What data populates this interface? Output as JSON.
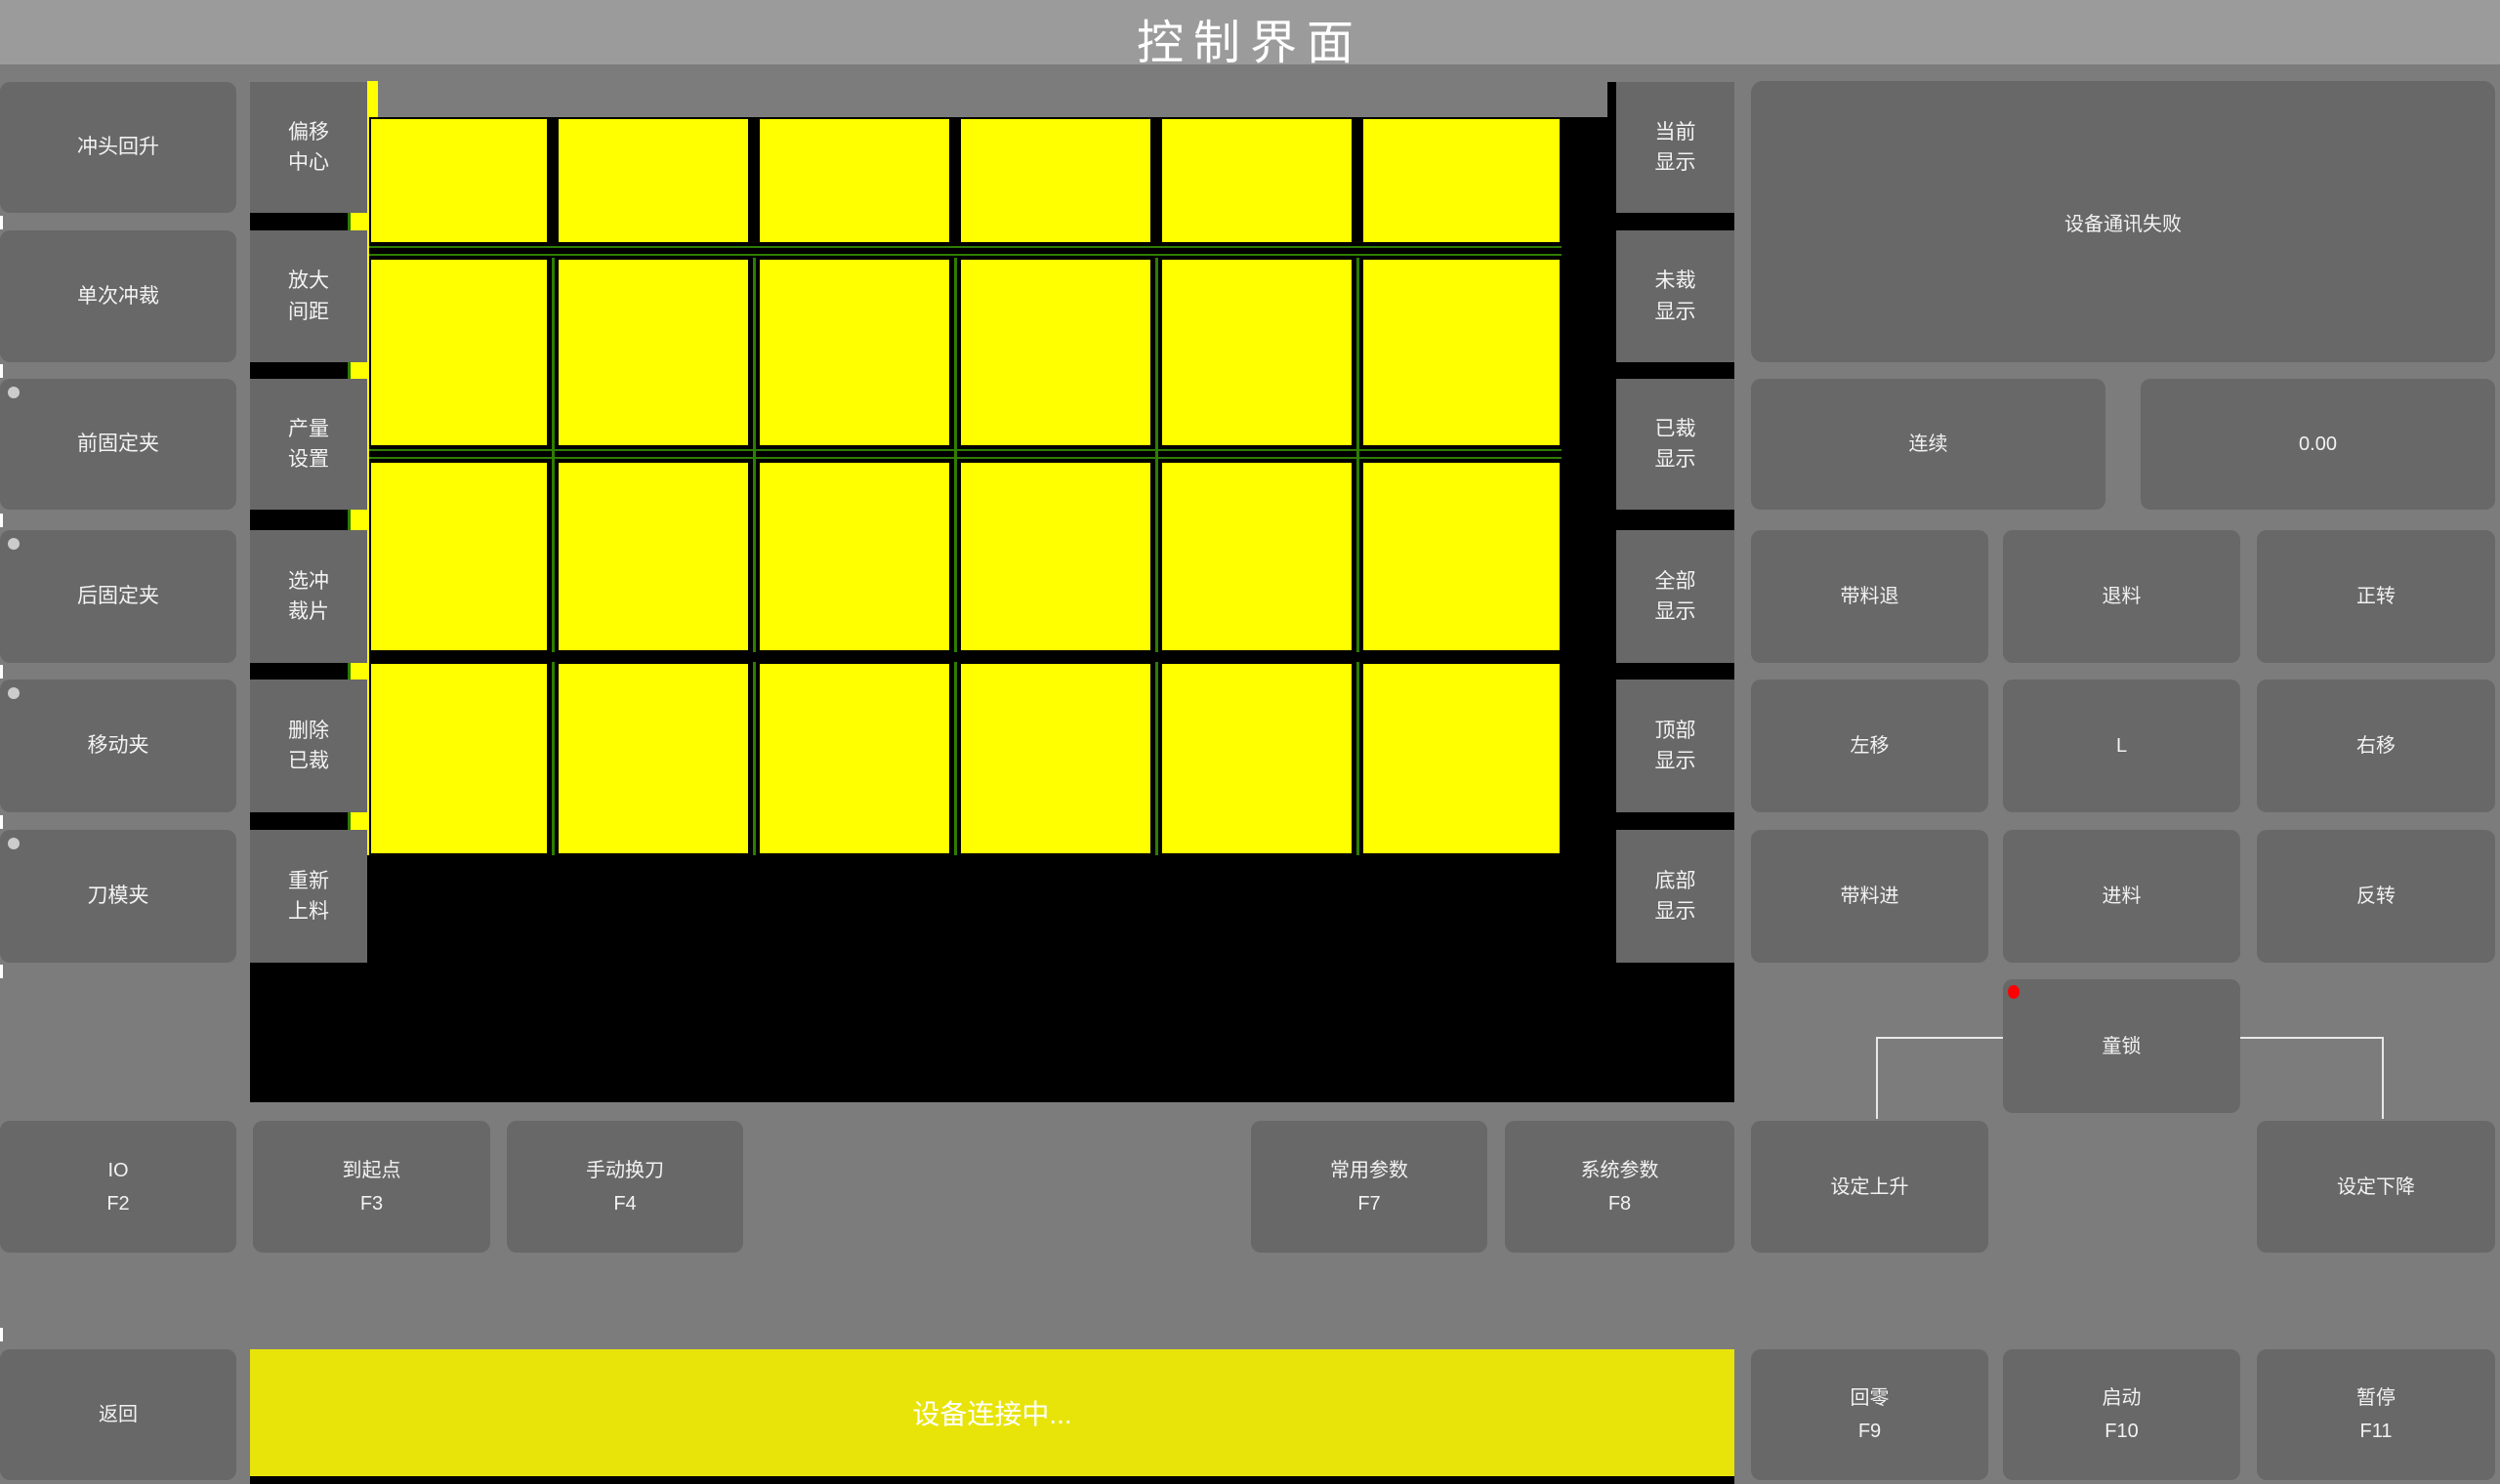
{
  "title": "控制界面",
  "left_panel": {
    "buttons": [
      {
        "label": "冲头回升",
        "indicator": false
      },
      {
        "label": "单次冲裁",
        "indicator": false
      },
      {
        "label": "前固定夹",
        "indicator": true
      },
      {
        "label": "后固定夹",
        "indicator": true
      },
      {
        "label": "移动夹",
        "indicator": true
      },
      {
        "label": "刀模夹",
        "indicator": true
      }
    ]
  },
  "tool_panel": {
    "buttons": [
      {
        "label": "偏移\n中心"
      },
      {
        "label": "放大\n间距"
      },
      {
        "label": "产量\n设置"
      },
      {
        "label": "选冲\n裁片"
      },
      {
        "label": "删除\n已裁"
      },
      {
        "label": "重新\n上料"
      }
    ]
  },
  "display_panel": {
    "buttons": [
      {
        "label": "当前\n显示"
      },
      {
        "label": "未裁\n显示"
      },
      {
        "label": "已裁\n显示"
      },
      {
        "label": "全部\n显示"
      },
      {
        "label": "顶部\n显示"
      },
      {
        "label": "底部\n显示"
      }
    ]
  },
  "status_panel": {
    "message": "设备通讯失败"
  },
  "feed_panel": {
    "continuous_label": "连续",
    "value": "0.00",
    "jog_buttons": [
      "带料退",
      "退料",
      "正转",
      "左移",
      "L",
      "右移",
      "带料进",
      "进料",
      "反转"
    ],
    "child_lock_label": "童锁"
  },
  "function_row": {
    "buttons": [
      {
        "label": "IO",
        "key": "F2"
      },
      {
        "label": "到起点",
        "key": "F3"
      },
      {
        "label": "手动换刀",
        "key": "F4"
      },
      {
        "label": "常用参数",
        "key": "F7"
      },
      {
        "label": "系统参数",
        "key": "F8"
      },
      {
        "label": "设定上升",
        "key": ""
      },
      {
        "label": "设定下降",
        "key": ""
      }
    ]
  },
  "bottom_bar": {
    "back_label": "返回",
    "status_message": "设备连接中...",
    "buttons": [
      {
        "label": "回零",
        "key": "F9"
      },
      {
        "label": "启动",
        "key": "F10"
      },
      {
        "label": "暂停",
        "key": "F11"
      }
    ]
  },
  "canvas": {
    "type": "cut-piece-layout",
    "piece_columns_x": [
      [
        378,
        562
      ],
      [
        570,
        768
      ],
      [
        776,
        974
      ],
      [
        982,
        1180
      ],
      [
        1188,
        1386
      ],
      [
        1394,
        1599
      ]
    ],
    "piece_rows_y": [
      [
        120,
        250
      ],
      [
        264,
        458
      ],
      [
        472,
        668
      ],
      [
        678,
        876
      ]
    ],
    "thick_divider_y": [
      668,
      678
    ],
    "left_channel_x": [
      359,
      378
    ],
    "origin": [
      256,
      120
    ]
  },
  "colors": {
    "accent_yellow": "#ffff00",
    "statusbar_yellow": "#e8e409",
    "outline_green": "#2e7d00",
    "alarm_red": "#ff0000",
    "indicator_gray": "#cccccc",
    "titlebar_gray": "#9b9b9b",
    "body_gray": "#7c7c7c",
    "button_gray": "#686868"
  }
}
